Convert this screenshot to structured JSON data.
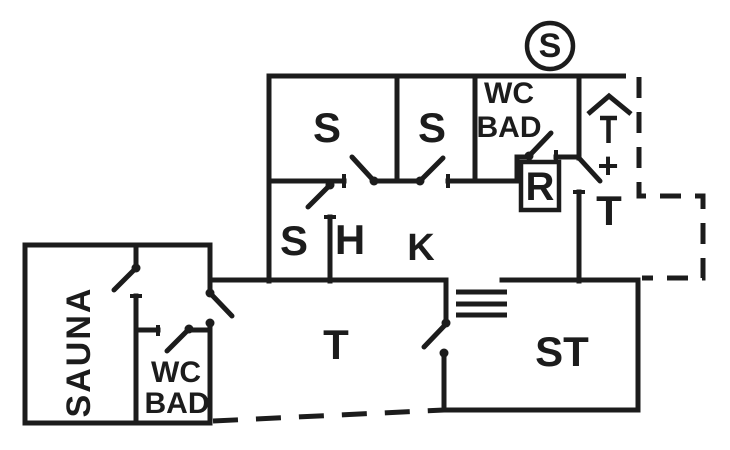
{
  "colors": {
    "ink": "#1c1c1c",
    "background": "#ffffff"
  },
  "plan": {
    "marker": "S",
    "upper_floor": {
      "bedroom_1": "S",
      "bedroom_2": "S",
      "bathroom_line1": "WC",
      "bathroom_line2": "BAD",
      "room_r": "R",
      "bedroom_3": "S",
      "hall": "H",
      "kitchen": "K"
    },
    "entrance": {
      "plus": "+",
      "terrace": "T"
    },
    "lower_floor": {
      "terrace": "T",
      "living_room": "ST"
    },
    "annex": {
      "sauna": "SAUNA",
      "bathroom_line1": "WC",
      "bathroom_line2": "BAD"
    }
  }
}
